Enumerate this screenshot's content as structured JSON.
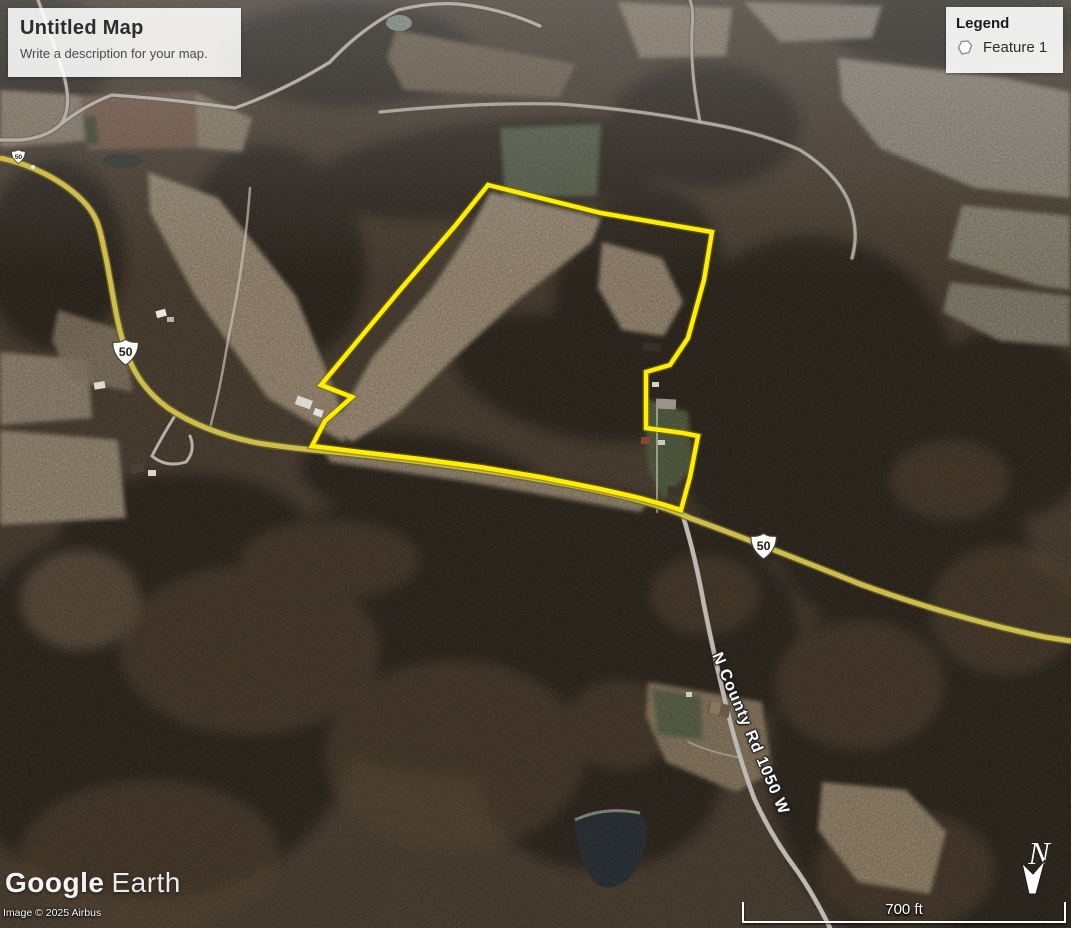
{
  "map_overlay": {
    "title": "Untitled Map",
    "description": "Write a description for your map."
  },
  "legend": {
    "title": "Legend",
    "items": [
      {
        "label": "Feature 1",
        "icon": "polygon-icon"
      }
    ]
  },
  "roads": {
    "route_shield": "50",
    "county_road_label": "N County Rd 1050 W"
  },
  "compass": {
    "label": "N"
  },
  "scale_bar": {
    "label": "700 ft"
  },
  "attribution": {
    "brand_primary": "Google",
    "brand_secondary": "Earth",
    "copyright": "Image © 2025 Airbus"
  },
  "feature": {
    "name": "Feature 1",
    "outline_color": "#FFEE00"
  },
  "colors": {
    "parcel_outline": "#FFEE00",
    "highway": "#CDBD50",
    "field_tan": "#B4A085",
    "woods_dark": "#241B13"
  }
}
